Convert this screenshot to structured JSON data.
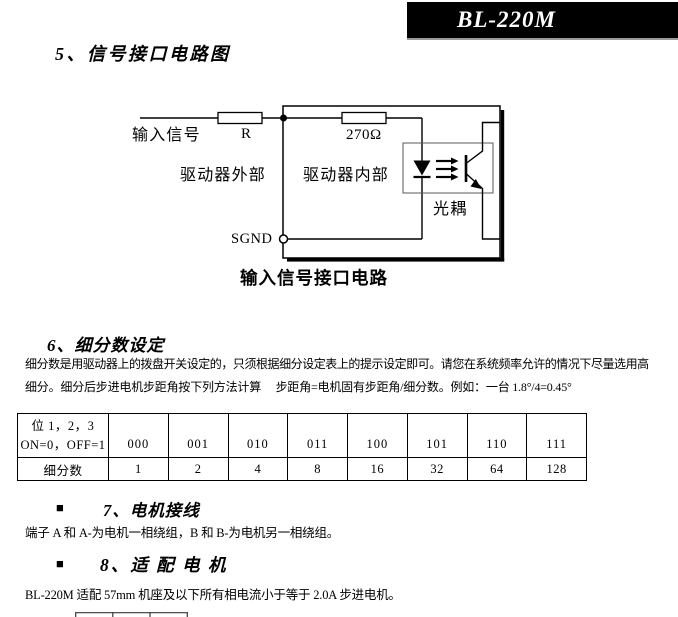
{
  "colors": {
    "banner_bg": "#000000",
    "banner_fg": "#ffffff",
    "ink": "#000000"
  },
  "banner": {
    "model": "BL-220M"
  },
  "s5": {
    "title": "5、信号接口电路图"
  },
  "diagram": {
    "input_signal": "输入信号",
    "resistor_r": "R",
    "resistor_270": "270Ω",
    "driver_external": "驱动器外部",
    "driver_internal": "驱动器内部",
    "optocoupler": "光耦",
    "sgnd": "SGND",
    "caption": "输入信号接口电路"
  },
  "s6": {
    "title": "6、细分数设定",
    "para_line1": "细分数是用驱动器上的拨盘开关设定的，只须根据细分设定表上的提示设定即可。请您在系统频率允许的情况下尽量选用高",
    "para_line2": "细分。细分后步进电机步距角按下列方法计算　 步距角=电机固有步距角/细分数。例如：一台 1.8°/4=0.45°",
    "table": {
      "bit_header_line1": "位 1，2，3",
      "bit_header_line2": "ON=0，OFF=1",
      "row_label": "细分数",
      "codes": [
        "000",
        "001",
        "010",
        "011",
        "100",
        "101",
        "110",
        "111"
      ],
      "values": [
        "1",
        "2",
        "4",
        "8",
        "16",
        "32",
        "64",
        "128"
      ]
    }
  },
  "s7": {
    "bullet": "■",
    "title": "7、电机接线",
    "para": "端子 A 和 A-为电机一相绕组，B 和 B-为电机另一相绕组。"
  },
  "s8": {
    "bullet": "■",
    "title": "8、适 配 电 机",
    "para": "BL-220M 适配 57mm 机座及以下所有相电流小于等于 2.0A 步进电机。"
  }
}
